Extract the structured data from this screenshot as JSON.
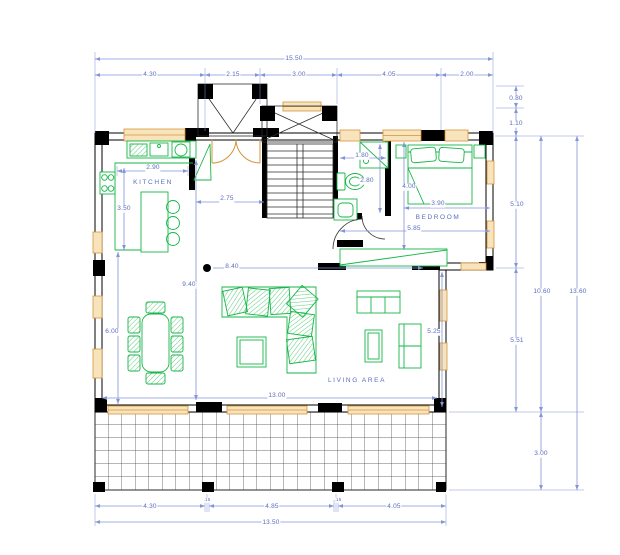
{
  "drawing": {
    "type": "architectural floor plan",
    "view": "ground floor with deck"
  },
  "colors": {
    "dimension_blue": "#8494d6",
    "text_blue": "#5b6cc0",
    "wall_black": "#000000",
    "furniture_green": "#16b648",
    "window_orange": "#d49339",
    "window_fill": "#f8e4bc"
  },
  "rooms": {
    "kitchen": "KITCHEN",
    "bedroom": "BEDROOM",
    "living": "LIVING AREA"
  },
  "dims": {
    "top_total": "15.50",
    "top_seg_1": "4.30",
    "top_seg_2": "2.15",
    "top_seg_3": "3.00",
    "top_seg_4": "4.05",
    "top_seg_5": "2.00",
    "canopy_offset": "0.80",
    "stair_offset": "1.10",
    "right_upper": "5.10",
    "right_lower": "5.51",
    "right_house_total": "10.60",
    "right_overall": "13.60",
    "deck_depth": "3.00",
    "bottom_seg_1": "4.30",
    "bottom_col_1": ".15",
    "bottom_seg_2": "4.85",
    "bottom_col_2": ".15",
    "bottom_seg_3": "4.05",
    "bottom_total": "13.50",
    "interior_width": "13.00",
    "kitchen_counter": "2.90",
    "kitchen_depth": "3.50",
    "entry_hall": "2.75",
    "bath_width": "1.80",
    "bath_depth": "2.80",
    "bedroom_depth": "4.00",
    "bedroom_width": "3.90",
    "bedroom_bath_width": "5.85",
    "living_span": "8.40",
    "living_depth": "9.40",
    "dining_zone": "6.00",
    "living_width": "5.25"
  }
}
